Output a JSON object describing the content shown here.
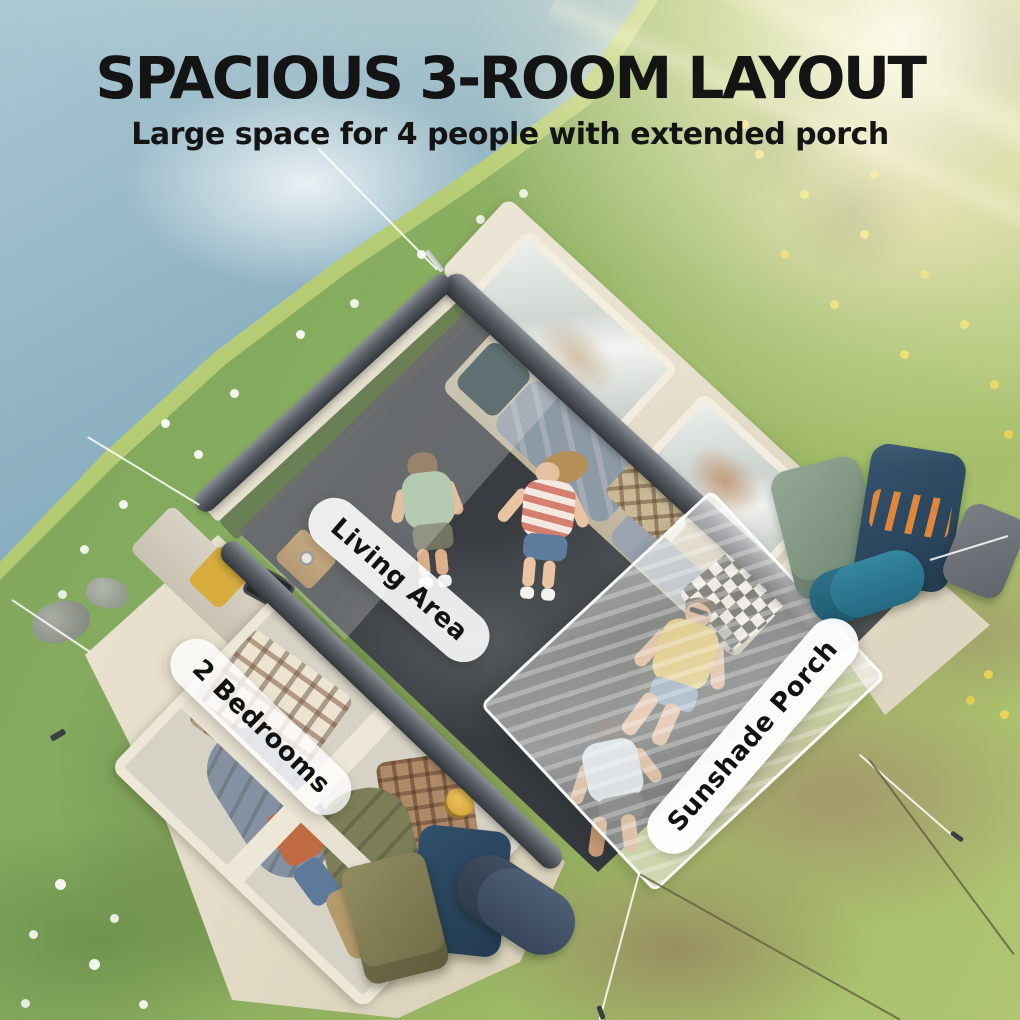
{
  "header": {
    "title": "SPACIOUS 3-ROOM LAYOUT",
    "subtitle": "Large space for 4 people with extended porch"
  },
  "labels": {
    "living_area": "Living Area",
    "bedrooms": "2 Bedrooms",
    "porch": "Sunshade Porch"
  },
  "colors": {
    "title_text": "#141414",
    "pill_background": "#ffffff",
    "pill_text": "#121212",
    "lake_water": "#8fb3c2",
    "grass_green": "#8cae60",
    "tent_fabric_cream": "#e9e2d2",
    "tent_beam_gray": "#4d5158",
    "living_floor_charcoal": "#3f4347",
    "porch_mesh": "#f3f1ea"
  }
}
